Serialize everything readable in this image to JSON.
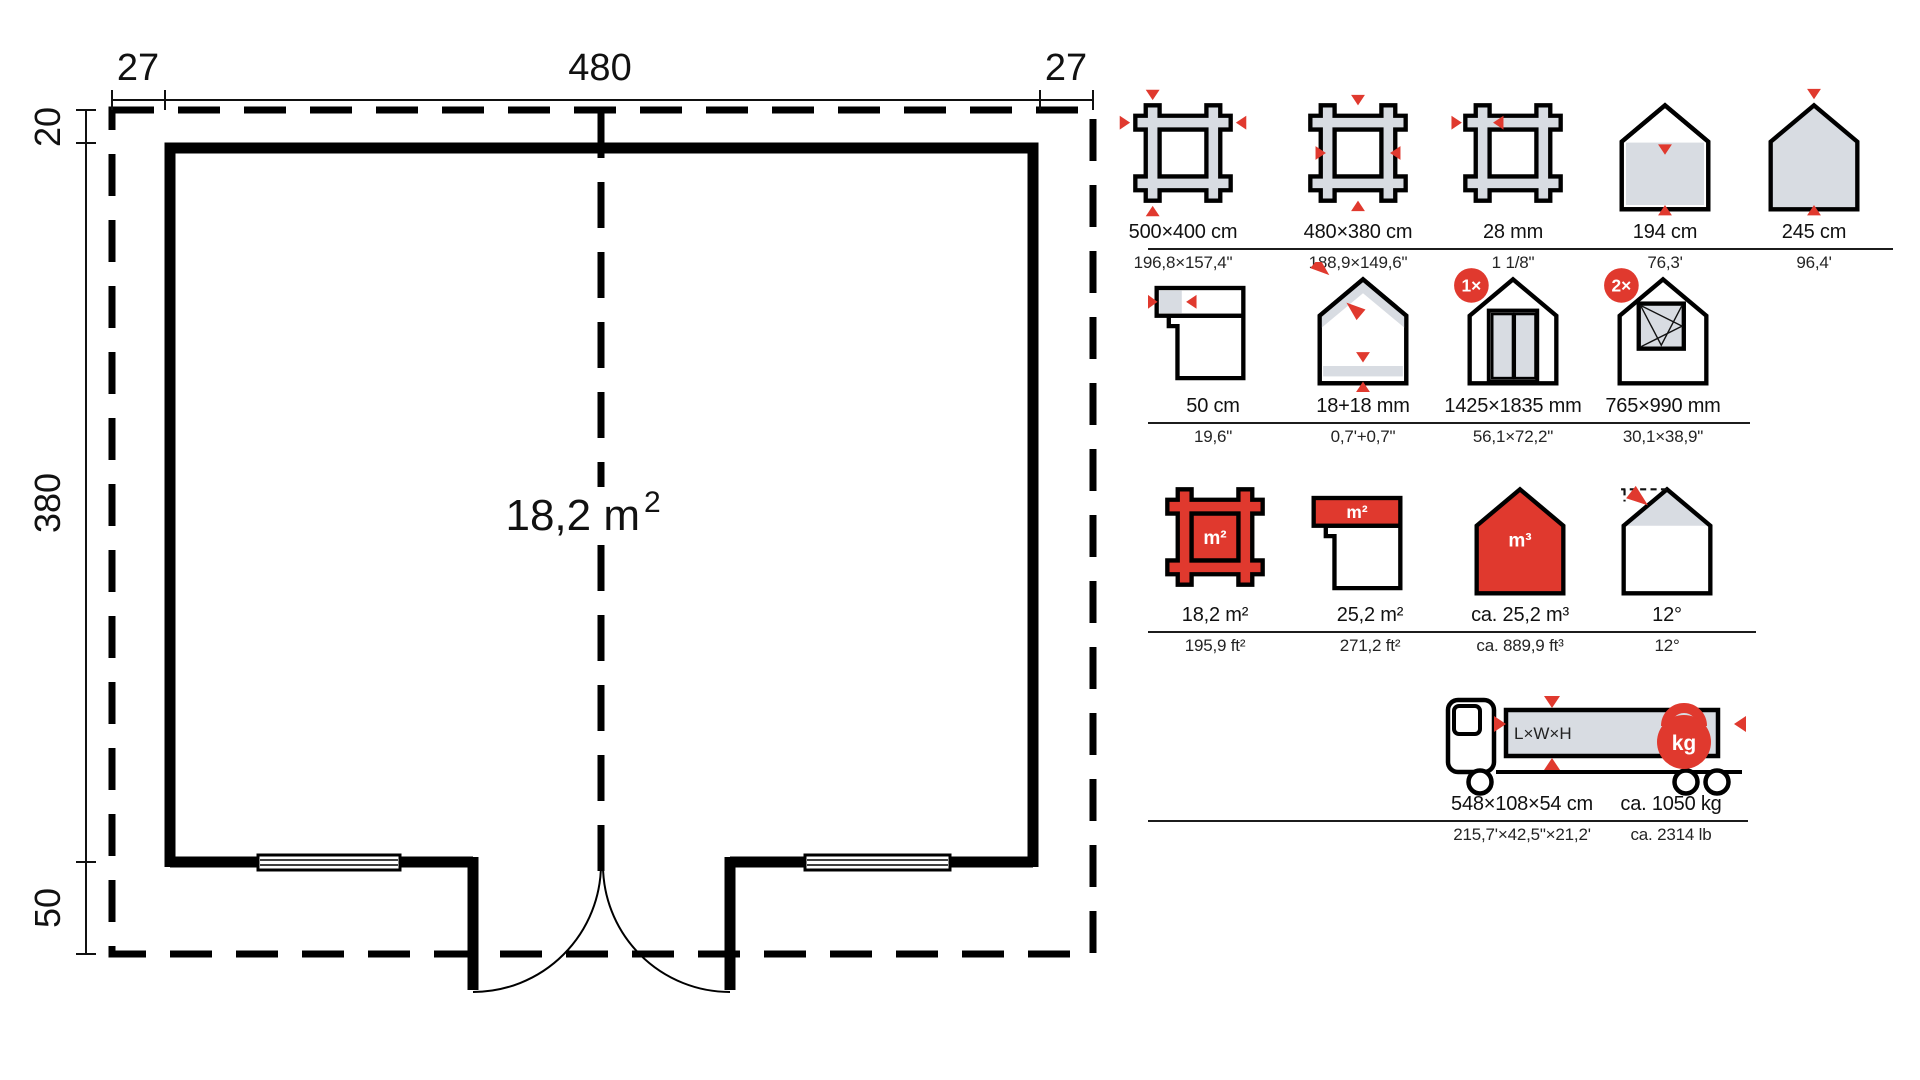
{
  "plan": {
    "dim_top_left": "27",
    "dim_top_center": "480",
    "dim_top_right": "27",
    "dim_left_top": "20",
    "dim_left_middle": "380",
    "dim_left_bottom": "50",
    "area_value": "18,2 m",
    "area_exponent": "2"
  },
  "specs": {
    "rows": [
      {
        "items": [
          {
            "icon": "outer-dimensions-frame",
            "metric": "500×400 cm",
            "imperial": "196,8×157,4\""
          },
          {
            "icon": "wall-dimensions-frame",
            "metric": "480×380 cm",
            "imperial": "188,9×149,6\""
          },
          {
            "icon": "wall-thickness",
            "metric": "28 mm",
            "imperial": "1 1/8\""
          },
          {
            "icon": "eaves-height-house",
            "metric": "194 cm",
            "imperial": "76,3'"
          },
          {
            "icon": "ridge-height-house",
            "metric": "245 cm",
            "imperial": "96,4'"
          }
        ]
      },
      {
        "items": [
          {
            "icon": "roof-overhang",
            "metric": "50 cm",
            "imperial": "19,6\""
          },
          {
            "icon": "roof-floor-boards",
            "metric": "18+18 mm",
            "imperial": "0,7'+0,7\""
          },
          {
            "icon": "double-door-house",
            "badge": "1×",
            "metric": "1425×1835 mm",
            "imperial": "56,1×72,2\""
          },
          {
            "icon": "window-house",
            "badge": "2×",
            "metric": "765×990 mm",
            "imperial": "30,1×38,9\""
          }
        ]
      },
      {
        "items": [
          {
            "icon": "floor-area-frame",
            "label": "m²",
            "metric": "18,2 m²",
            "imperial": "195,9 ft²"
          },
          {
            "icon": "roof-area",
            "label": "m²",
            "metric": "25,2 m²",
            "imperial": "271,2 ft²"
          },
          {
            "icon": "volume-house",
            "label": "m³",
            "metric": "ca. 25,2 m³",
            "imperial": "ca. 889,9 ft³"
          },
          {
            "icon": "roof-pitch-house",
            "metric": "12°",
            "imperial": "12°"
          }
        ]
      },
      {
        "truck": {
          "cargo_label": "L×W×H",
          "weight_label": "kg",
          "dimensions": {
            "metric": "548×108×54 cm",
            "imperial": "215,7'×42,5\"×21,2'"
          },
          "weight": {
            "metric": "ca. 1050 kg",
            "imperial": "ca. 2314 lb"
          }
        }
      }
    ]
  },
  "colors": {
    "accent_red": "#e0392e",
    "icon_gray": "#d8dce2",
    "line_black": "#000000"
  }
}
